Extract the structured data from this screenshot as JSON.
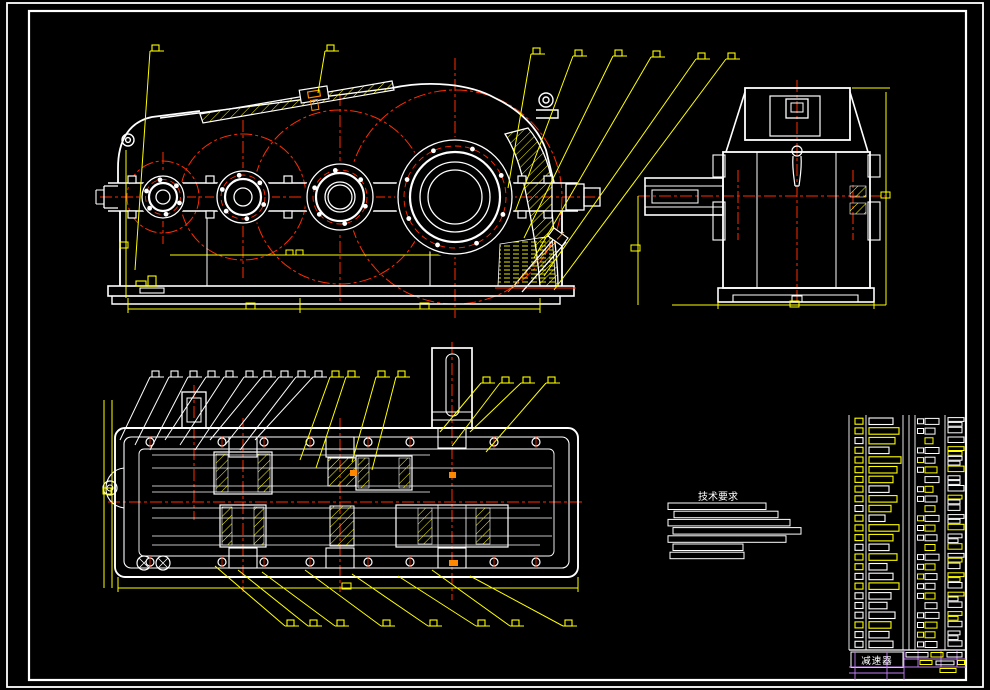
{
  "app": {
    "type": "cad-engineering-drawing",
    "background": "#000000"
  },
  "colors": {
    "line": "#ffffff",
    "annotation": "#ffff00",
    "centerline": "#ff2d00",
    "accent_orange": "#ff8800",
    "table_accent": "#c07ef5"
  },
  "title_block": {
    "name": "减速器"
  },
  "tech_requirements": {
    "heading": "技术要求",
    "line_widths": [
      98,
      104,
      122,
      128,
      118,
      70,
      74
    ]
  },
  "parts_list": {
    "rows": [
      {
        "i": "y",
        "n": [
          24,
          "w"
        ],
        "q": "w",
        "m": [
          14,
          "w"
        ],
        "r": [
          [
            16,
            "w"
          ],
          [
            14,
            "w"
          ]
        ]
      },
      {
        "i": "y",
        "n": [
          30,
          "y"
        ],
        "q": "w",
        "m": [
          10,
          "w"
        ],
        "r": [
          [
            14,
            "w"
          ]
        ]
      },
      {
        "i": "w",
        "n": [
          26,
          "y"
        ],
        "q": null,
        "m": [
          8,
          "y"
        ],
        "r": [
          [
            16,
            "w"
          ]
        ]
      },
      {
        "i": "y",
        "n": [
          20,
          "w"
        ],
        "q": "w",
        "m": [
          14,
          "w"
        ],
        "r": [
          [
            16,
            "y"
          ],
          [
            14,
            "y"
          ]
        ]
      },
      {
        "i": "y",
        "n": [
          32,
          "y"
        ],
        "q": "y",
        "m": [
          10,
          "w"
        ],
        "r": [
          [
            14,
            "w"
          ],
          [
            12,
            "w"
          ]
        ]
      },
      {
        "i": "y",
        "n": [
          28,
          "y"
        ],
        "q": "w",
        "m": [
          12,
          "y"
        ],
        "r": [
          [
            16,
            "y"
          ]
        ]
      },
      {
        "i": "y",
        "n": [
          24,
          "y"
        ],
        "q": null,
        "m": [
          14,
          "w"
        ],
        "r": [
          [
            12,
            "w"
          ],
          [
            12,
            "w"
          ]
        ]
      },
      {
        "i": "y",
        "n": [
          20,
          "w"
        ],
        "q": "w",
        "m": [
          8,
          "y"
        ],
        "r": [
          [
            16,
            "w"
          ]
        ]
      },
      {
        "i": "y",
        "n": [
          28,
          "y"
        ],
        "q": "w",
        "m": [
          12,
          "w"
        ],
        "r": [
          [
            14,
            "y"
          ],
          [
            12,
            "w"
          ]
        ]
      },
      {
        "i": "w",
        "n": [
          22,
          "y"
        ],
        "q": null,
        "m": [
          10,
          "y"
        ],
        "r": [
          [
            12,
            "w"
          ]
        ]
      },
      {
        "i": "y",
        "n": [
          16,
          "w"
        ],
        "q": "y",
        "m": [
          14,
          "w"
        ],
        "r": [
          [
            16,
            "w"
          ],
          [
            12,
            "w"
          ]
        ]
      },
      {
        "i": "y",
        "n": [
          30,
          "y"
        ],
        "q": "w",
        "m": [
          10,
          "y"
        ],
        "r": [
          [
            16,
            "y"
          ]
        ]
      },
      {
        "i": "y",
        "n": [
          24,
          "y"
        ],
        "q": "w",
        "m": [
          12,
          "w"
        ],
        "r": [
          [
            14,
            "w"
          ],
          [
            10,
            "w"
          ]
        ]
      },
      {
        "i": "w",
        "n": [
          20,
          "w"
        ],
        "q": null,
        "m": [
          10,
          "y"
        ],
        "r": [
          [
            14,
            "y"
          ]
        ]
      },
      {
        "i": "y",
        "n": [
          28,
          "y"
        ],
        "q": "w",
        "m": [
          14,
          "w"
        ],
        "r": [
          [
            16,
            "w"
          ],
          [
            14,
            "y"
          ]
        ]
      },
      {
        "i": "y",
        "n": [
          18,
          "w"
        ],
        "q": "w",
        "m": [
          10,
          "y"
        ],
        "r": [
          [
            12,
            "w"
          ]
        ]
      },
      {
        "i": "w",
        "n": [
          24,
          "w"
        ],
        "q": "y",
        "m": [
          12,
          "w"
        ],
        "r": [
          [
            16,
            "y"
          ],
          [
            12,
            "y"
          ]
        ]
      },
      {
        "i": "y",
        "n": [
          30,
          "y"
        ],
        "q": "w",
        "m": [
          10,
          "w"
        ],
        "r": [
          [
            14,
            "w"
          ]
        ]
      },
      {
        "i": "w",
        "n": [
          22,
          "w"
        ],
        "q": "w",
        "m": [
          10,
          "y"
        ],
        "r": [
          [
            16,
            "y"
          ],
          [
            10,
            "w"
          ]
        ]
      },
      {
        "i": "w",
        "n": [
          18,
          "w"
        ],
        "q": null,
        "m": [
          12,
          "w"
        ],
        "r": [
          [
            14,
            "w"
          ]
        ]
      },
      {
        "i": "w",
        "n": [
          26,
          "w"
        ],
        "q": "w",
        "m": [
          14,
          "w"
        ],
        "r": [
          [
            14,
            "y"
          ],
          [
            10,
            "y"
          ]
        ]
      },
      {
        "i": "y",
        "n": [
          22,
          "y"
        ],
        "q": "w",
        "m": [
          12,
          "y"
        ],
        "r": [
          [
            14,
            "w"
          ]
        ]
      },
      {
        "i": "w",
        "n": [
          20,
          "w"
        ],
        "q": "y",
        "m": [
          10,
          "y"
        ],
        "r": [
          [
            12,
            "w"
          ],
          [
            10,
            "w"
          ]
        ]
      },
      {
        "i": "w",
        "n": [
          24,
          "w"
        ],
        "q": "w",
        "m": [
          12,
          "w"
        ],
        "r": [
          [
            14,
            "w"
          ]
        ]
      }
    ]
  }
}
